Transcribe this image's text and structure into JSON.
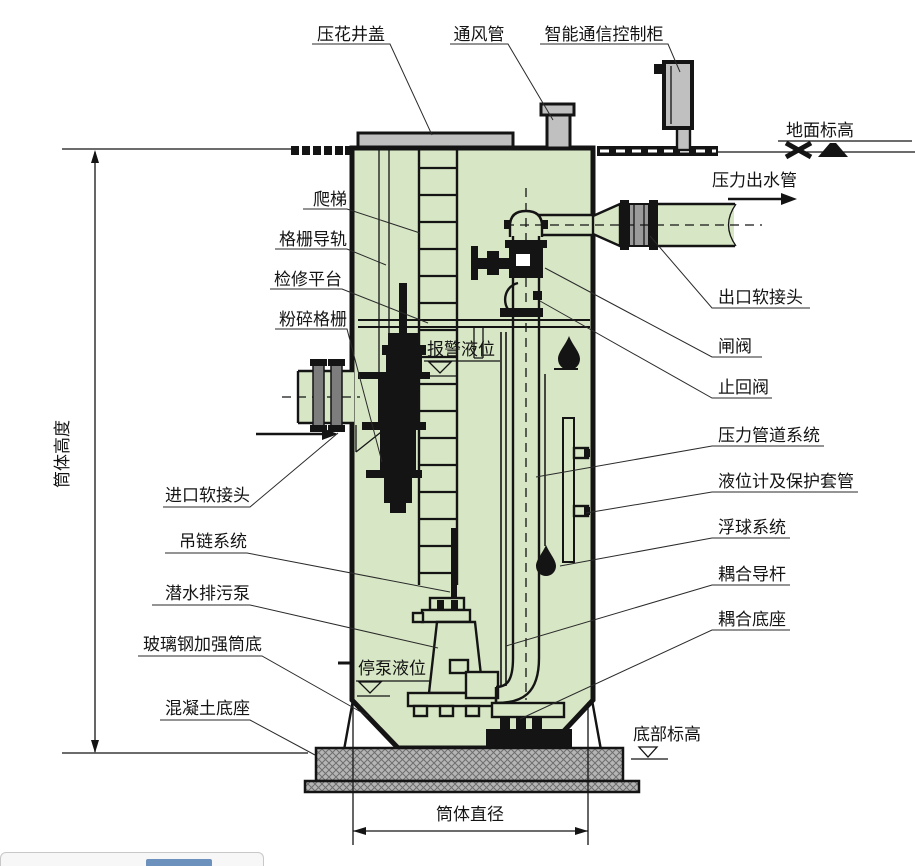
{
  "diagram": {
    "labels": {
      "manhole_cover": "压花井盖",
      "vent_pipe": "通风管",
      "control_cabinet": "智能通信控制柜",
      "ground_elevation": "地面标高",
      "pressure_outlet_pipe": "压力出水管",
      "outlet_flexible_joint": "出口软接头",
      "gate_valve": "闸阀",
      "check_valve": "止回阀",
      "pressure_piping_system": "压力管道系统",
      "level_gauge_sleeve": "液位计及保护套管",
      "float_system": "浮球系统",
      "coupling_guide_rod": "耦合导杆",
      "coupling_base": "耦合底座",
      "bottom_elevation": "底部标高",
      "ladder": "爬梯",
      "grille_guide_rail": "格栅导轨",
      "service_platform": "检修平台",
      "crushing_grille": "粉碎格栅",
      "alarm_water_level": "报警液位",
      "inlet_flexible_joint": "进口软接头",
      "chain_hoist_system": "吊链系统",
      "submersible_sewage_pump": "潜水排污泵",
      "frp_reinforced_bottom": "玻璃钢加强筒底",
      "concrete_base": "混凝土底座",
      "stop_pump_level": "停泵液位",
      "tank_height": "筒体高度",
      "tank_diameter": "筒体直径"
    },
    "colors": {
      "tank_fill": "#d7e6c4",
      "metal_gray": "#c0c0c0",
      "joint_gray": "#9a9a9a",
      "flange_gray": "#7d7d7d",
      "concrete_gray": "#b5b5b5",
      "line_black": "#141414",
      "artifact_blue": "#3d6fa8"
    }
  }
}
